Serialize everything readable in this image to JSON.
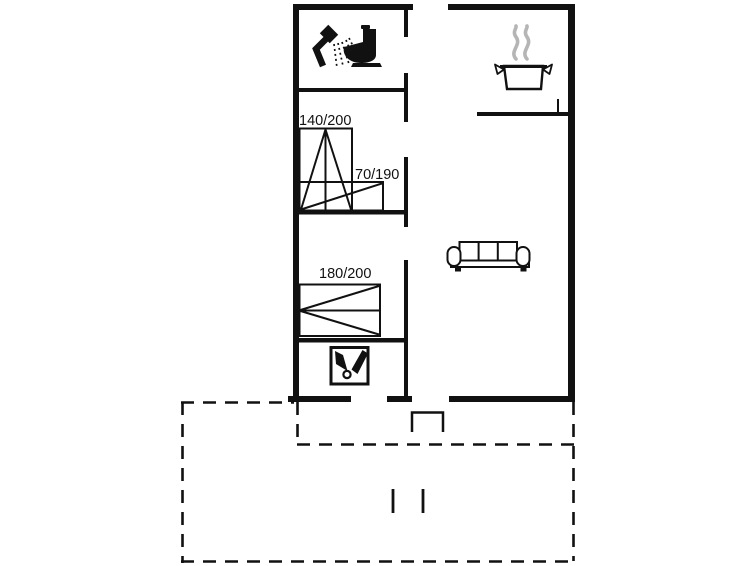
{
  "plan": {
    "type": "vacation-house-floor-plan",
    "beds": [
      {
        "label": "140/200"
      },
      {
        "label": "70/190"
      },
      {
        "label": "180/200"
      }
    ],
    "icons": [
      {
        "name": "shower-icon"
      },
      {
        "name": "toilet-icon"
      },
      {
        "name": "cooking-pot-icon"
      },
      {
        "name": "steam-icon"
      },
      {
        "name": "sofa-icon"
      },
      {
        "name": "utility-tools-icon"
      },
      {
        "name": "entrance-step"
      },
      {
        "name": "terrace-dashed-outline"
      }
    ],
    "colors": {
      "line": "#111111",
      "steam": "#b5b5b5",
      "background": "#ffffff"
    }
  }
}
